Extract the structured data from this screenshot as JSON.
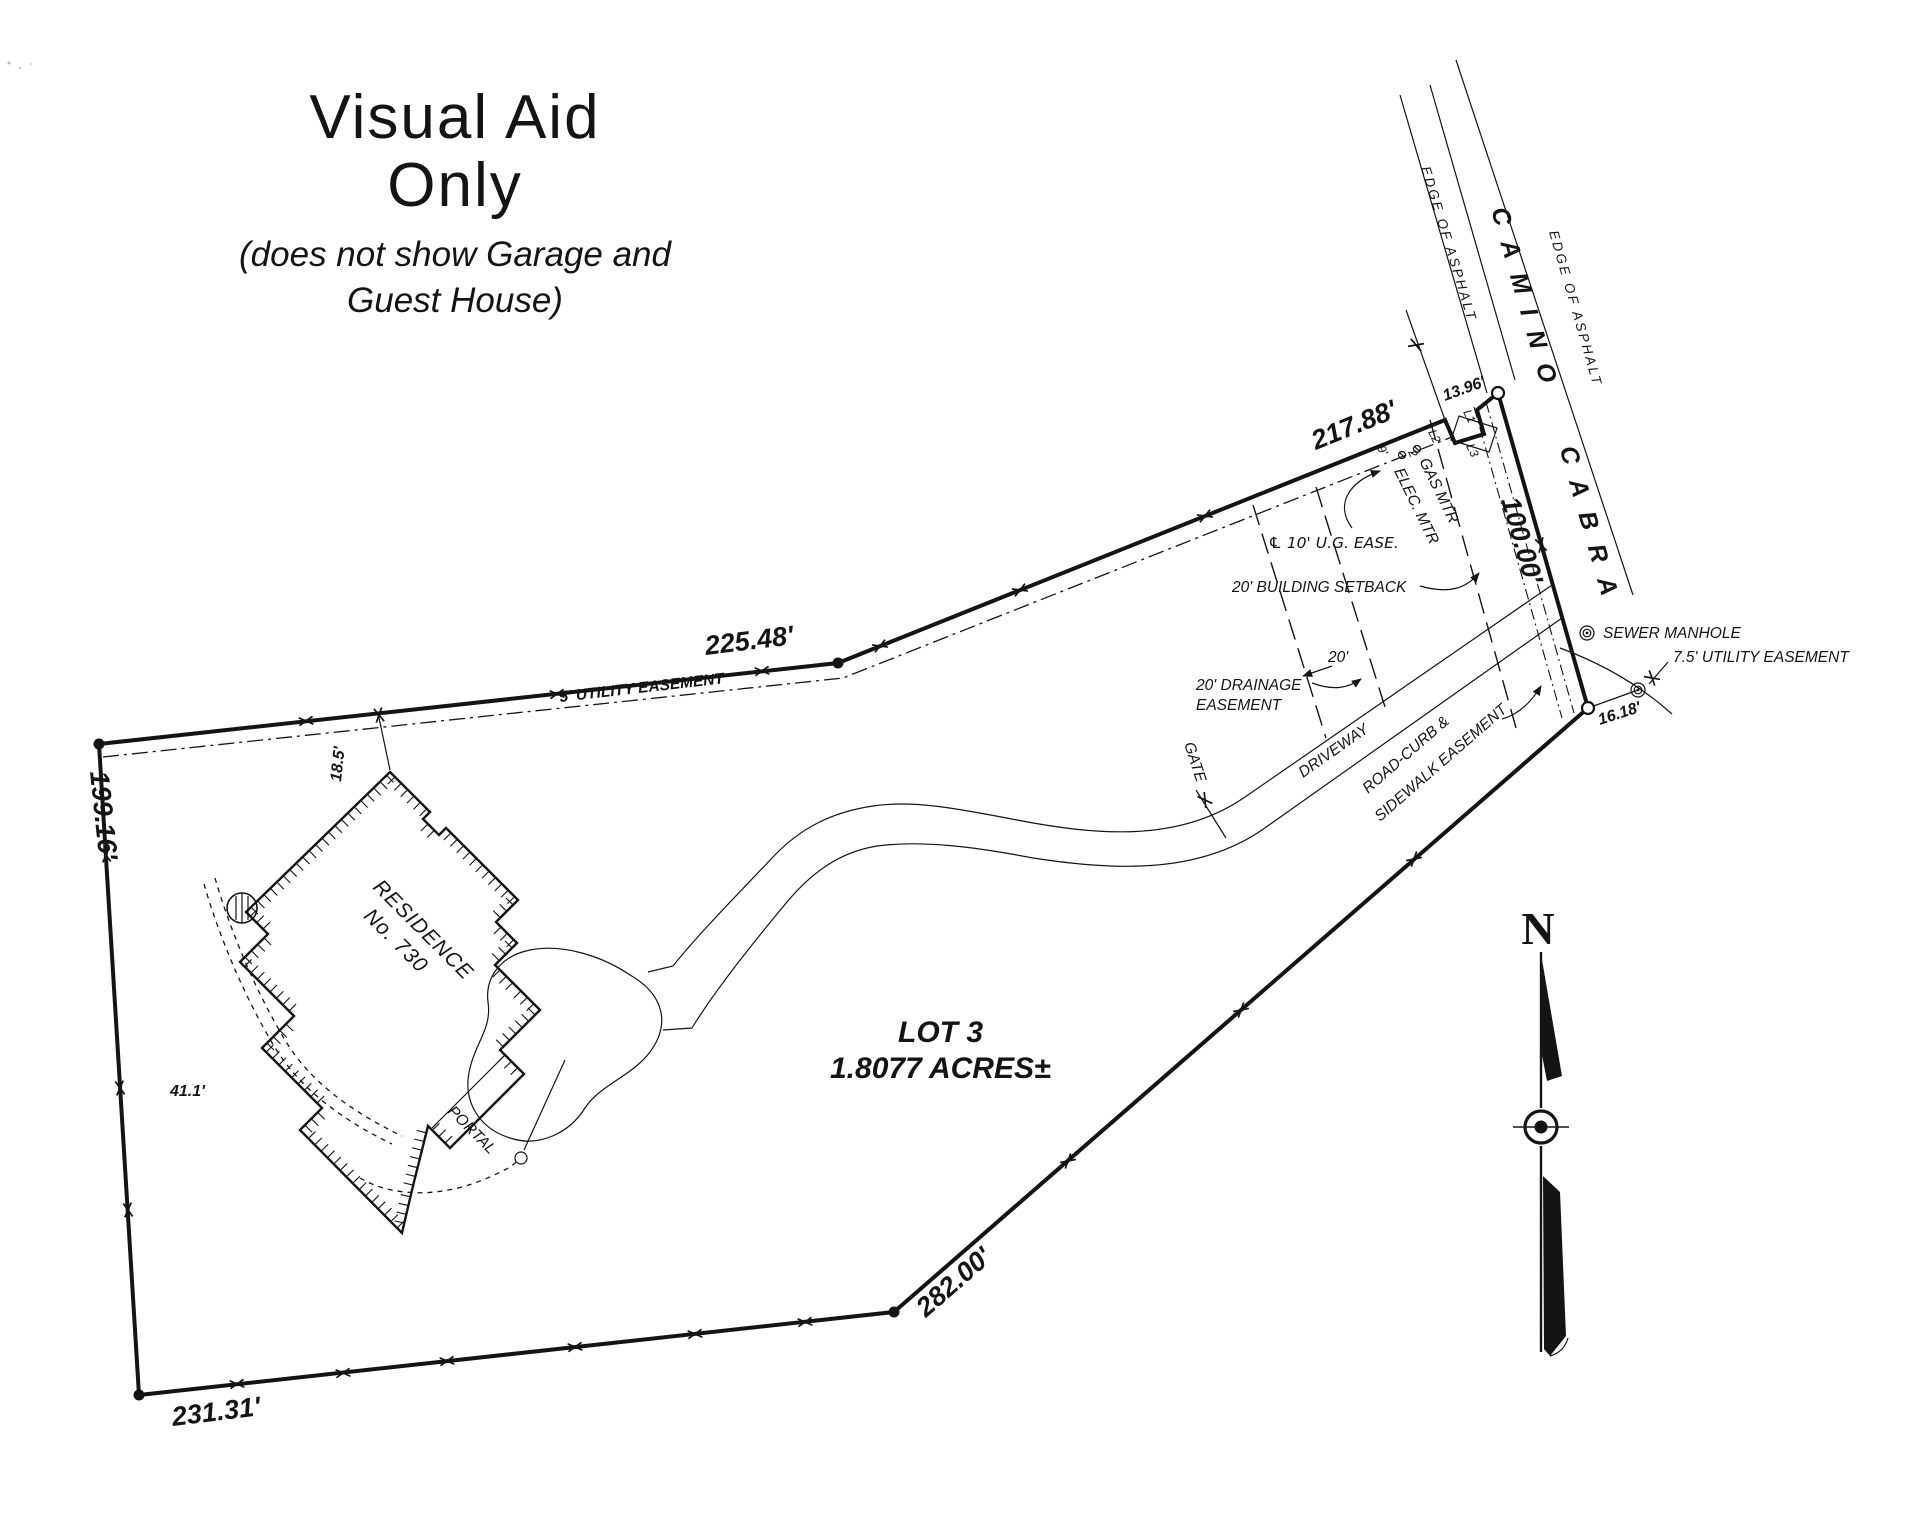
{
  "page": {
    "background": "#ffffff",
    "ink": "#141414"
  },
  "header": {
    "title_line1": "Visual Aid",
    "title_line2": "Only",
    "subtitle_line1": "(does not show Garage and",
    "subtitle_line2": "Guest House)"
  },
  "street": {
    "name": "CAMINO CABRA",
    "edge_left": "EDGE OF ASPHALT",
    "edge_right": "EDGE OF ASPHALT"
  },
  "lot": {
    "name": "LOT 3",
    "area": "1.8077 ACRES±",
    "dims": {
      "north": "217.88'",
      "northwest": "225.48'",
      "west": "199.16'",
      "south": "231.31'",
      "southeast": "282.00'",
      "frontage": "100.00'",
      "tie_north": "13.96'",
      "tie_south": "16.18'"
    },
    "segments": {
      "l1": "L1",
      "l2": "L2",
      "l3": "L3"
    }
  },
  "easements": {
    "utility5": "5' UTILITY EASEMENT",
    "ug10": "℄ 10' U.G. EASE.",
    "setback": "20' BUILDING SETBACK",
    "drainage1": "20' DRAINAGE",
    "drainage2": "EASEMENT",
    "drainage_width": "20'",
    "roadcurb1": "ROAD-CURB &",
    "roadcurb2": "SIDEWALK EASEMENT",
    "utility75": "7.5' UTILITY EASEMENT"
  },
  "site": {
    "sewer": "SEWER MANHOLE",
    "driveway": "DRIVEWAY",
    "gate": "GATE",
    "residence1": "RESIDENCE",
    "residence2": "No. 730",
    "portal": "PORTAL",
    "gas": "GAS MTR",
    "elec": "ELEC. MTR",
    "dim9": "9'",
    "dim2": "2",
    "tie_house": "18.5'",
    "wing": "41.1'"
  },
  "compass": {
    "north": "N"
  }
}
